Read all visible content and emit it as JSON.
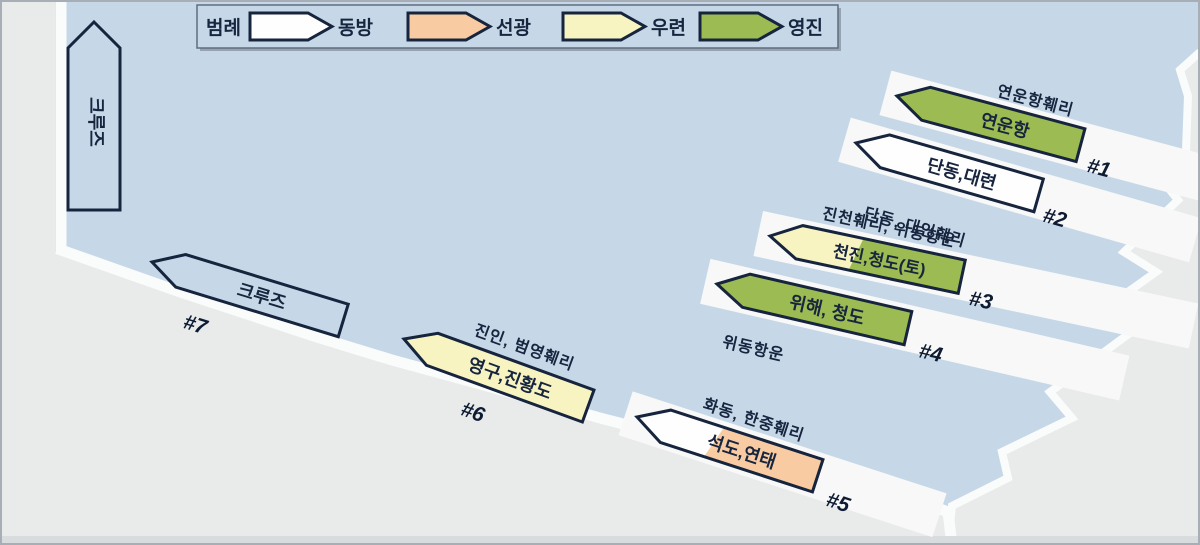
{
  "colors": {
    "water": "#c6d8e8",
    "land": "#e9eaea",
    "quay_edge": "#fafbfb",
    "quay_strip": "#f7f8f7",
    "outline": "#16243e",
    "text": "#17253f"
  },
  "legend": {
    "title": "범례",
    "items": [
      {
        "name": "동방",
        "color": "#fefefe"
      },
      {
        "name": "선광",
        "color": "#f8cba3"
      },
      {
        "name": "우련",
        "color": "#f7f4c2"
      },
      {
        "name": "영진",
        "color": "#9cbb52"
      }
    ]
  },
  "left_pier": {
    "label": "크루즈"
  },
  "berths": [
    {
      "number": "#1",
      "label": "연운항",
      "annotation": "연운항훼리",
      "fill": "#9cbb52"
    },
    {
      "number": "#2",
      "label": "단동,대련",
      "annotation": "단동, 대인훼리",
      "fill": "#fefefe"
    },
    {
      "number": "#3",
      "label": "천진,청도(토)",
      "annotation": "진천훼리, 위동항운",
      "fill": "#9cbb52",
      "fill_tip": "#f7f4c2"
    },
    {
      "number": "#4",
      "label": "위해, 청도",
      "annotation": "위동항운",
      "fill": "#9cbb52"
    },
    {
      "number": "#5",
      "label": "석도,연태",
      "annotation": "화동, 한중훼리",
      "fill": "#f8cba3",
      "fill_tip": "#fefefe"
    },
    {
      "number": "#6",
      "label": "영구,진황도",
      "annotation": "진인, 범영훼리",
      "fill": "#f7f4c2"
    },
    {
      "number": "#7",
      "label": "크루즈",
      "annotation": "",
      "fill": "#c6d8e8"
    }
  ]
}
